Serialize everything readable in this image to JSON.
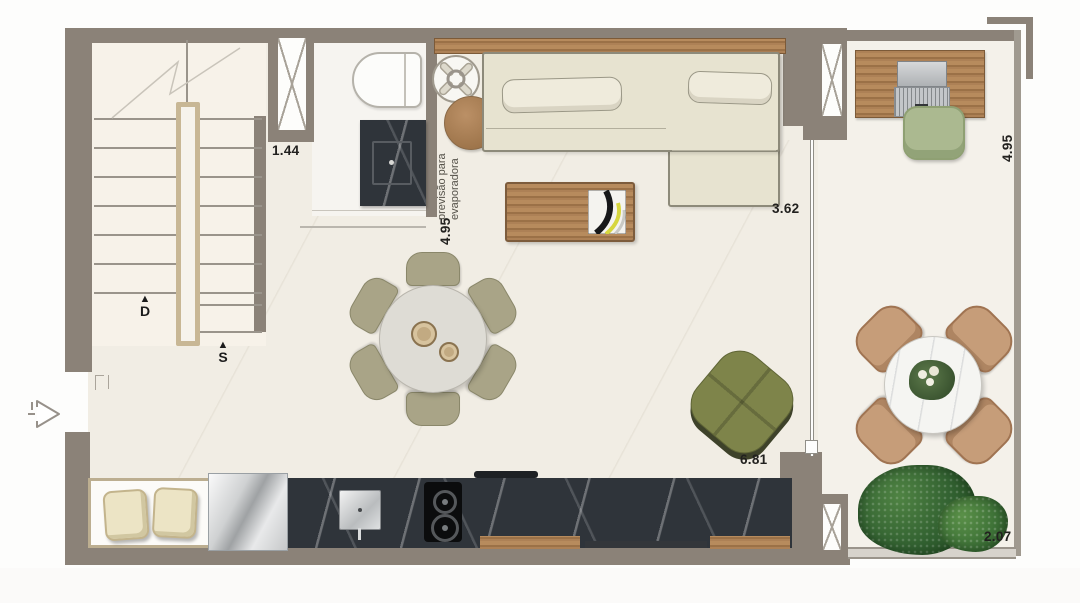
{
  "labels": {
    "dim_hall": "1.44",
    "dim_bath_depth": "4.95",
    "dim_living_width": "3.62",
    "dim_kitchen_width": "6.81",
    "dim_balcony_depth": "4.95",
    "dim_balcony_width": "2.07",
    "stair_down": "D",
    "stair_up": "S",
    "up_arrow": "▲",
    "note_line1": "previsão para",
    "note_line2": "evaporadora"
  },
  "colors": {
    "wall": "#8b8278",
    "floor": "#f1ede4",
    "stair_floor": "#f7f2e9",
    "bathroom_floor": "#f6f4f0",
    "balcony_floor": "#f4f1ea",
    "wood": "#a9805a",
    "dark_marble": "#2f343a",
    "sofa_beige": "#e7e3d0",
    "olive_chair": "#a9a487",
    "bean_bag_green": "#7e844a",
    "desk_chair_green": "#abb990",
    "outdoor_chair_tan": "#c69d79",
    "plant_green": "#316030",
    "dimension_text": "#22211f"
  }
}
